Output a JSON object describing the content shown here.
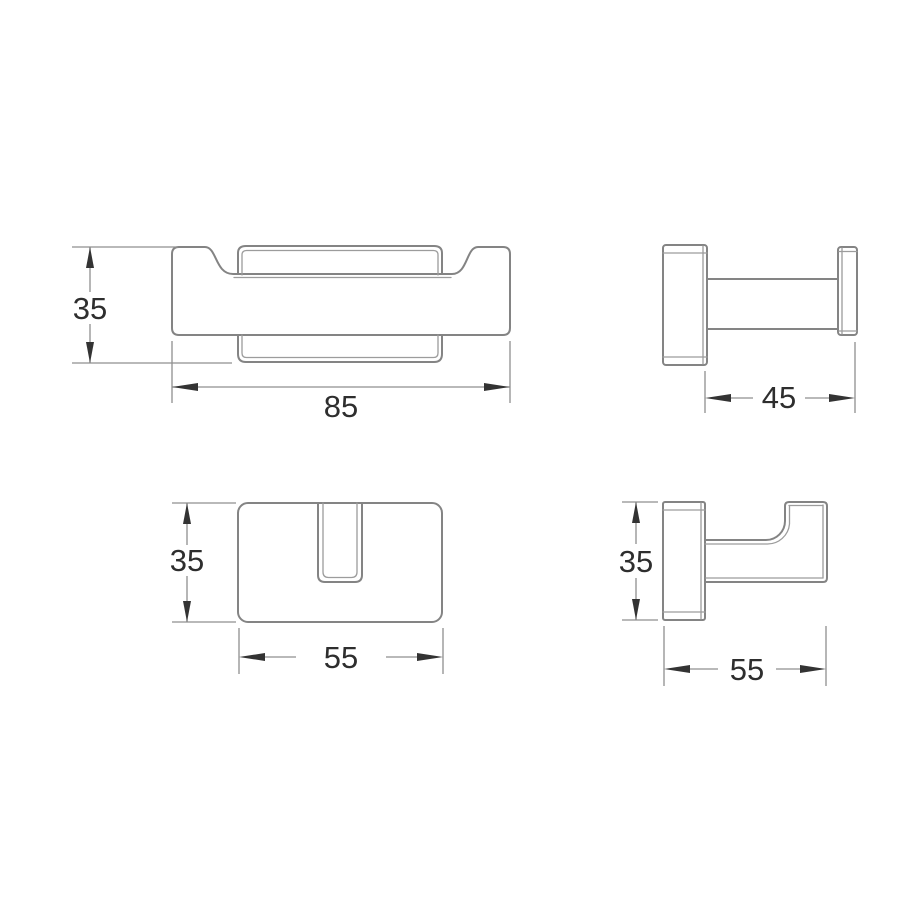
{
  "colors": {
    "background": "#ffffff",
    "geometry_stroke": "#848484",
    "detail_stroke": "#9c9c9c",
    "dimension_stroke": "#8f8f8f",
    "arrow_fill": "#333333",
    "text_fill": "#2e2e2e"
  },
  "views": {
    "front": {
      "height_dim": "35",
      "width_dim": "85"
    },
    "side": {
      "depth_dim": "45"
    },
    "plan": {
      "height_dim": "35",
      "width_dim": "55"
    },
    "profile": {
      "height_dim": "35",
      "width_dim": "55"
    }
  }
}
